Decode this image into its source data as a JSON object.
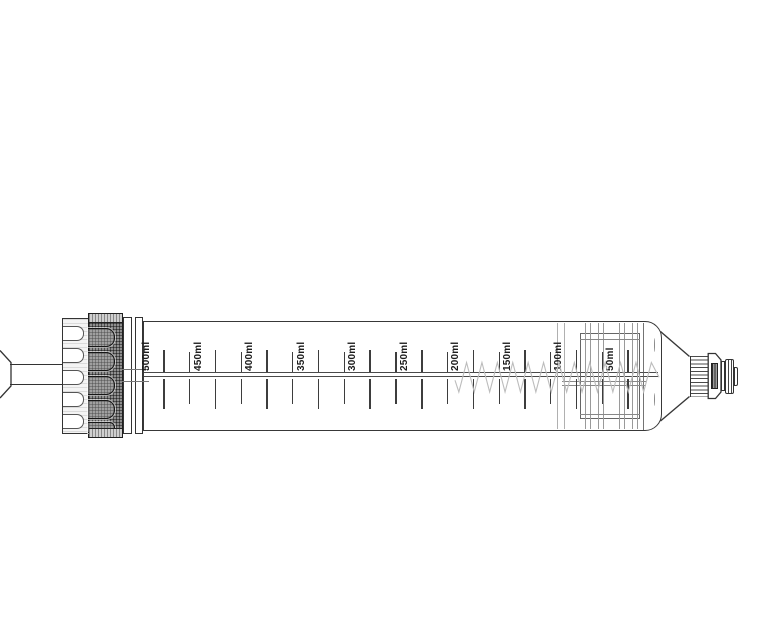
{
  "meta": {
    "description": "Technical line drawing of a graduated cartridge syringe with knurled end cap, plunger rod, internal piston and threaded nozzle tip"
  },
  "colors": {
    "background": "#ffffff",
    "ink": "#383838",
    "mid_line": "#666666",
    "light_line": "#aaaaaa",
    "label_text": "#1c1c1c",
    "watermark": "#bcbcbc",
    "knurl_base": "#8f8f8f"
  },
  "scale": {
    "unit_labels": [
      "500ml",
      "450ml",
      "400ml",
      "350ml",
      "300ml",
      "250ml",
      "200ml",
      "150ml",
      "100ml",
      "50ml"
    ],
    "first_major_x": 164,
    "major_step": 51.55,
    "minor_offset": 25.8,
    "baseline_y": 371,
    "above_tick": {
      "major": [
        350,
        22
      ],
      "minor": [
        351.5,
        20.5
      ]
    },
    "below_tick": {
      "major": [
        379,
        30
      ],
      "minor": [
        379,
        25
      ]
    }
  },
  "cap": {
    "rib_ys": [
      325,
      347,
      369,
      391,
      413
    ],
    "rib_height": 14.5,
    "slot_ys": [
      327,
      351,
      375,
      399
    ],
    "slot_height": 19,
    "slot_partial": {
      "y": 421,
      "height": 11
    }
  },
  "piston": {
    "rib_xs": [
      585,
      590,
      598,
      603,
      619,
      624,
      632,
      637
    ],
    "hairline_xs": [
      557,
      564
    ],
    "band_ys": [
      381,
      385
    ],
    "inner_ys": [
      338.5,
      414
    ]
  },
  "watermark": {
    "start_x": 455,
    "end_x": 654,
    "peak_y": 362.5,
    "trough_y": 392,
    "half_period": 7.7
  }
}
